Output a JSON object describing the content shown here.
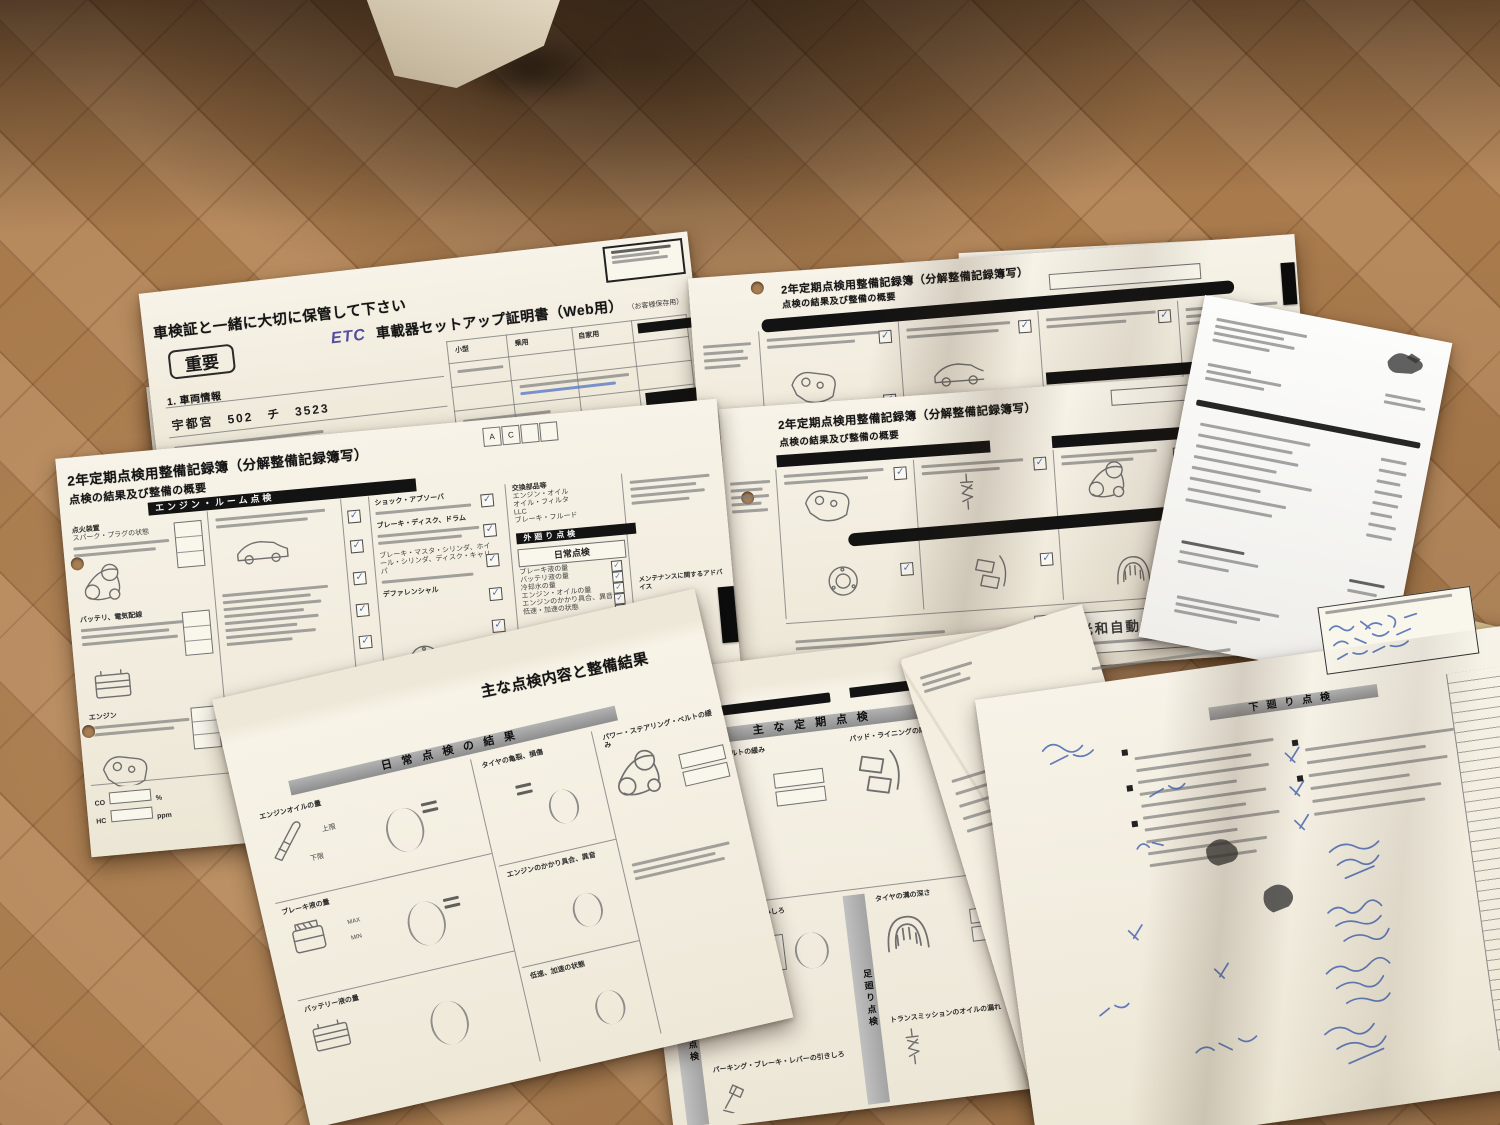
{
  "documents": {
    "etc": {
      "keep_notice": "車検証と一緒に大切に保管して下さい",
      "important_badge": "重要",
      "brand": "ETC",
      "title": "車載器セットアップ証明書（Web用）",
      "subtitle": "（お客様保存用）",
      "section_vehicle_info": "1. 車両情報",
      "license_plate": "宇都宮　502　チ　3523",
      "field_labels": {
        "f1": "小型",
        "f2": "乗用",
        "f3": "自家用"
      }
    },
    "tokutei": {
      "title": "2年定期点検用整備記録簿（特定整備記録簿写）",
      "summary_label": "点検の結果及び整備の概要",
      "section_engine_room": "エンジン・ルーム点検",
      "note": "C",
      "cell_letters": {
        "a": "A",
        "c": "C"
      }
    },
    "bunkai_left": {
      "title": "2年定期点検用整備記録簿（分解整備記録簿写）",
      "summary_label": "点検の結果及び整備の概要",
      "section_engine_room": "エンジン・ルーム点検",
      "section_exterior": "外廻り点検",
      "section_undercarriage": "足廻り点検",
      "section_daily": "日常点検",
      "cell_letters": {
        "a": "A",
        "c": "C"
      },
      "items_colA": {
        "i1": "点火装置",
        "i2": "スパーク・プラグの状態",
        "i3": "バッテリ、電気配線",
        "i4": "エンジン"
      },
      "items_colC": {
        "i1": "ショック・アブソーバ",
        "i2": "ブレーキ・ディスク、ドラム",
        "i3": "ブレーキ・マスタ・シリンダ、ホイール・シリンダ、ディスク・キャリパ",
        "i4": "デファレンシャル"
      },
      "daily_items": {
        "i1": "ブレーキ液の量",
        "i2": "バッテリ液の量",
        "i3": "冷却水の量",
        "i4": "エンジン・オイルの量",
        "i5": "エンジンのかかり具合、異音",
        "i6": "低速・加速の状態"
      },
      "parts_box_title": "交換部品等",
      "parts": {
        "p1": "エンジン・オイル",
        "p2": "オイル・フィルタ",
        "p3": "LLC",
        "p4": "ブレーキ・フルード"
      },
      "advice_label": "メンテナンスに関するアドバイス",
      "co_label": "CO",
      "co_unit": "%",
      "hc_label": "HC",
      "hc_unit": "ppm",
      "tire_tread_label": "タイヤの溝の深さ",
      "front_label": "前輪",
      "rear_label": "後輪",
      "right_label": "右",
      "left_label": "左",
      "mm_unit": "mm"
    },
    "bunkai_tr": {
      "title": "2年定期点検用整備記録簿（分解整備記録簿写）",
      "summary_label": "点検の結果及び整備の概要"
    },
    "bunkai_mr": {
      "title": "2年定期点検用整備記録簿（分解整備記録簿写）",
      "summary_label": "点検の結果及び整備の概要",
      "shop_stamp": "光和自動車工業所"
    },
    "results": {
      "title": "主な点検内容と整備結果",
      "periodic_header": "主な定期点検",
      "daily_header": "日常点検の結果",
      "vertical_engine_room": "エンジンルーム点検",
      "vertical_interior": "室内点検",
      "vertical_undercarriage": "足廻り点検",
      "vertical_underbody": "下廻り点検",
      "item_engine_oil": "エンジンオイルの量",
      "item_tire_crack": "タイヤの亀裂、損傷",
      "item_engine_start": "エンジンのかかり具合、異音",
      "item_brake_fluid": "ブレーキ液の量",
      "item_speed": "低速、加速の状態",
      "item_battery_fluid": "バッテリー液の量",
      "item_ps_belt": "パワー・ステアリング・ベルトの緩み",
      "item_alt_belt": "オルタネータ・ベルトの緩み",
      "item_pad": "パッド・ライニングの摩耗",
      "item_brake_pedal": "ブレーキ・ペダルの踏みしろ",
      "item_tire_groove": "タイヤの溝の深さ",
      "item_parking_brake": "パーキング・ブレーキ・レバーの引きしろ",
      "item_transmission": "トランスミッションのオイルの漏れ",
      "dipstick_upper": "上限",
      "dipstick_lower": "下限",
      "max_label": "MAX",
      "min_label": "MIN"
    },
    "handwritten": {
      "section_label": "下廻り点検"
    },
    "booklet": {
      "cover_word": "mainte",
      "accent_color": "#2e63c4"
    }
  }
}
